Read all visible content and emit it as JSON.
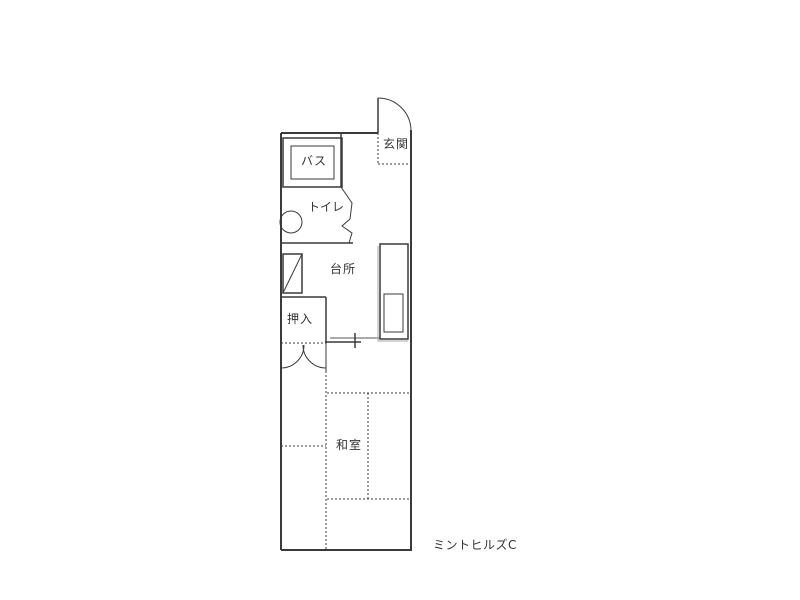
{
  "plan": {
    "building_label": "ミントヒルズC",
    "rooms": {
      "genkan": {
        "label": "玄関"
      },
      "bath": {
        "label": "バス"
      },
      "toilet": {
        "label": "トイレ"
      },
      "kitchen": {
        "label": "台所"
      },
      "closet": {
        "label": "押入"
      },
      "washitsu": {
        "label": "和室"
      }
    },
    "fixtures": [
      "entrance-door-swing-arc",
      "bath-unit-tub",
      "toilet-bowl-circle",
      "washing-machine-pan",
      "kitchen-counter-sink",
      "closet-double-door-arcs",
      "tatami-mat-dividers"
    ],
    "colors": {
      "line": "#3a3a3a",
      "shadow": "#aaaaaa",
      "background": "#ffffff"
    }
  }
}
